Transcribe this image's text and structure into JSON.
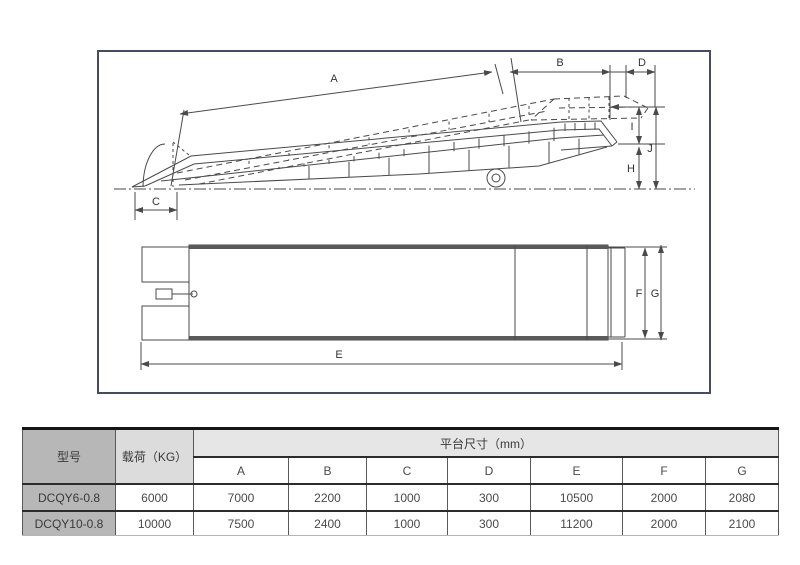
{
  "colors": {
    "box_border": "#454c61",
    "drawing_line": "#4a4a4a",
    "table_model_bg": "#b7b7b7",
    "table_load_bg": "#dcdcdc",
    "table_platform_bg": "#e6e6e6"
  },
  "diagram": {
    "labels": {
      "A": "A",
      "B": "B",
      "C": "C",
      "D": "D",
      "E": "E",
      "F": "F",
      "G": "G",
      "H": "H",
      "I": "I",
      "J": "J"
    }
  },
  "table": {
    "col_model": "型号",
    "col_load": "载荷（KG）",
    "col_platform": "平台尺寸（mm）",
    "dim_headers": [
      "A",
      "B",
      "C",
      "D",
      "E",
      "F",
      "G"
    ],
    "rows": [
      {
        "model": "DCQY6-0.8",
        "load": "6000",
        "dims": [
          "7000",
          "2200",
          "1000",
          "300",
          "10500",
          "2000",
          "2080"
        ]
      },
      {
        "model": "DCQY10-0.8",
        "load": "10000",
        "dims": [
          "7500",
          "2400",
          "1000",
          "300",
          "11200",
          "2000",
          "2100"
        ]
      }
    ]
  }
}
